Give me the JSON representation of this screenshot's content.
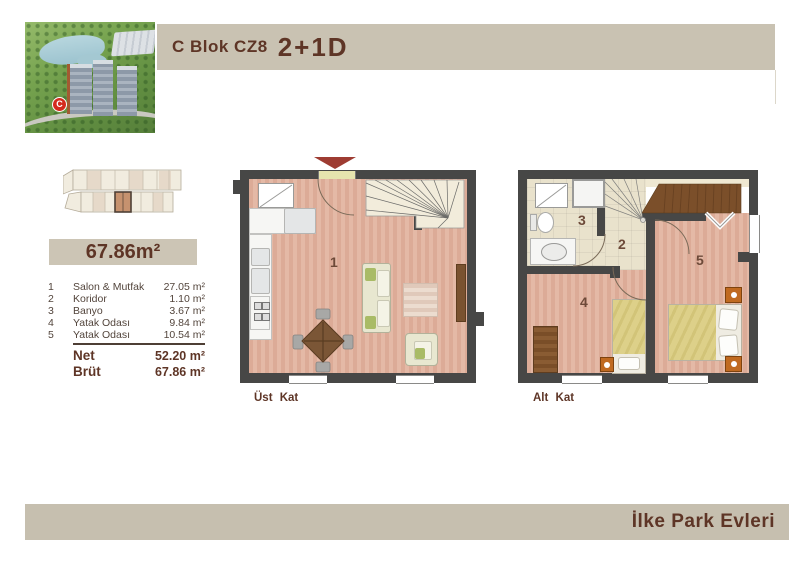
{
  "header": {
    "title": "C Blok CZ8",
    "variant": "2+1D"
  },
  "footer": {
    "brand": "İlke Park Evleri"
  },
  "summary": {
    "total_area": "67.86m²"
  },
  "table": {
    "rows": [
      {
        "num": "1",
        "name": "Salon & Mutfak",
        "value": "27.05 m²"
      },
      {
        "num": "2",
        "name": "Koridor",
        "value": "1.10 m²"
      },
      {
        "num": "3",
        "name": "Banyo",
        "value": "3.67 m²"
      },
      {
        "num": "4",
        "name": "Yatak Odası",
        "value": "9.84 m²"
      },
      {
        "num": "5",
        "name": "Yatak Odası",
        "value": "10.54 m²"
      }
    ],
    "totals": [
      {
        "label": "Net",
        "value": "52.20 m²"
      },
      {
        "label": "Brüt",
        "value": "67.86 m²"
      }
    ]
  },
  "plans": {
    "upper": {
      "label": "Üst Kat",
      "room1": "1"
    },
    "lower": {
      "label": "Alt Kat",
      "room2": "2",
      "room3": "3",
      "room4": "4",
      "room5": "5"
    }
  },
  "photo": {
    "marker": "C"
  },
  "colors": {
    "accent_brown": "#5e3526",
    "band_beige": "#c9c2b2",
    "wall_dark": "#474746",
    "wood_floor": "#ddae9a",
    "tile_beige": "#e9e2cc",
    "dark_wood": "#7b4f2a",
    "entry_arrow": "#9e3c32",
    "marker_red": "#d42b1e",
    "nightstand_orange": "#c06a20"
  }
}
